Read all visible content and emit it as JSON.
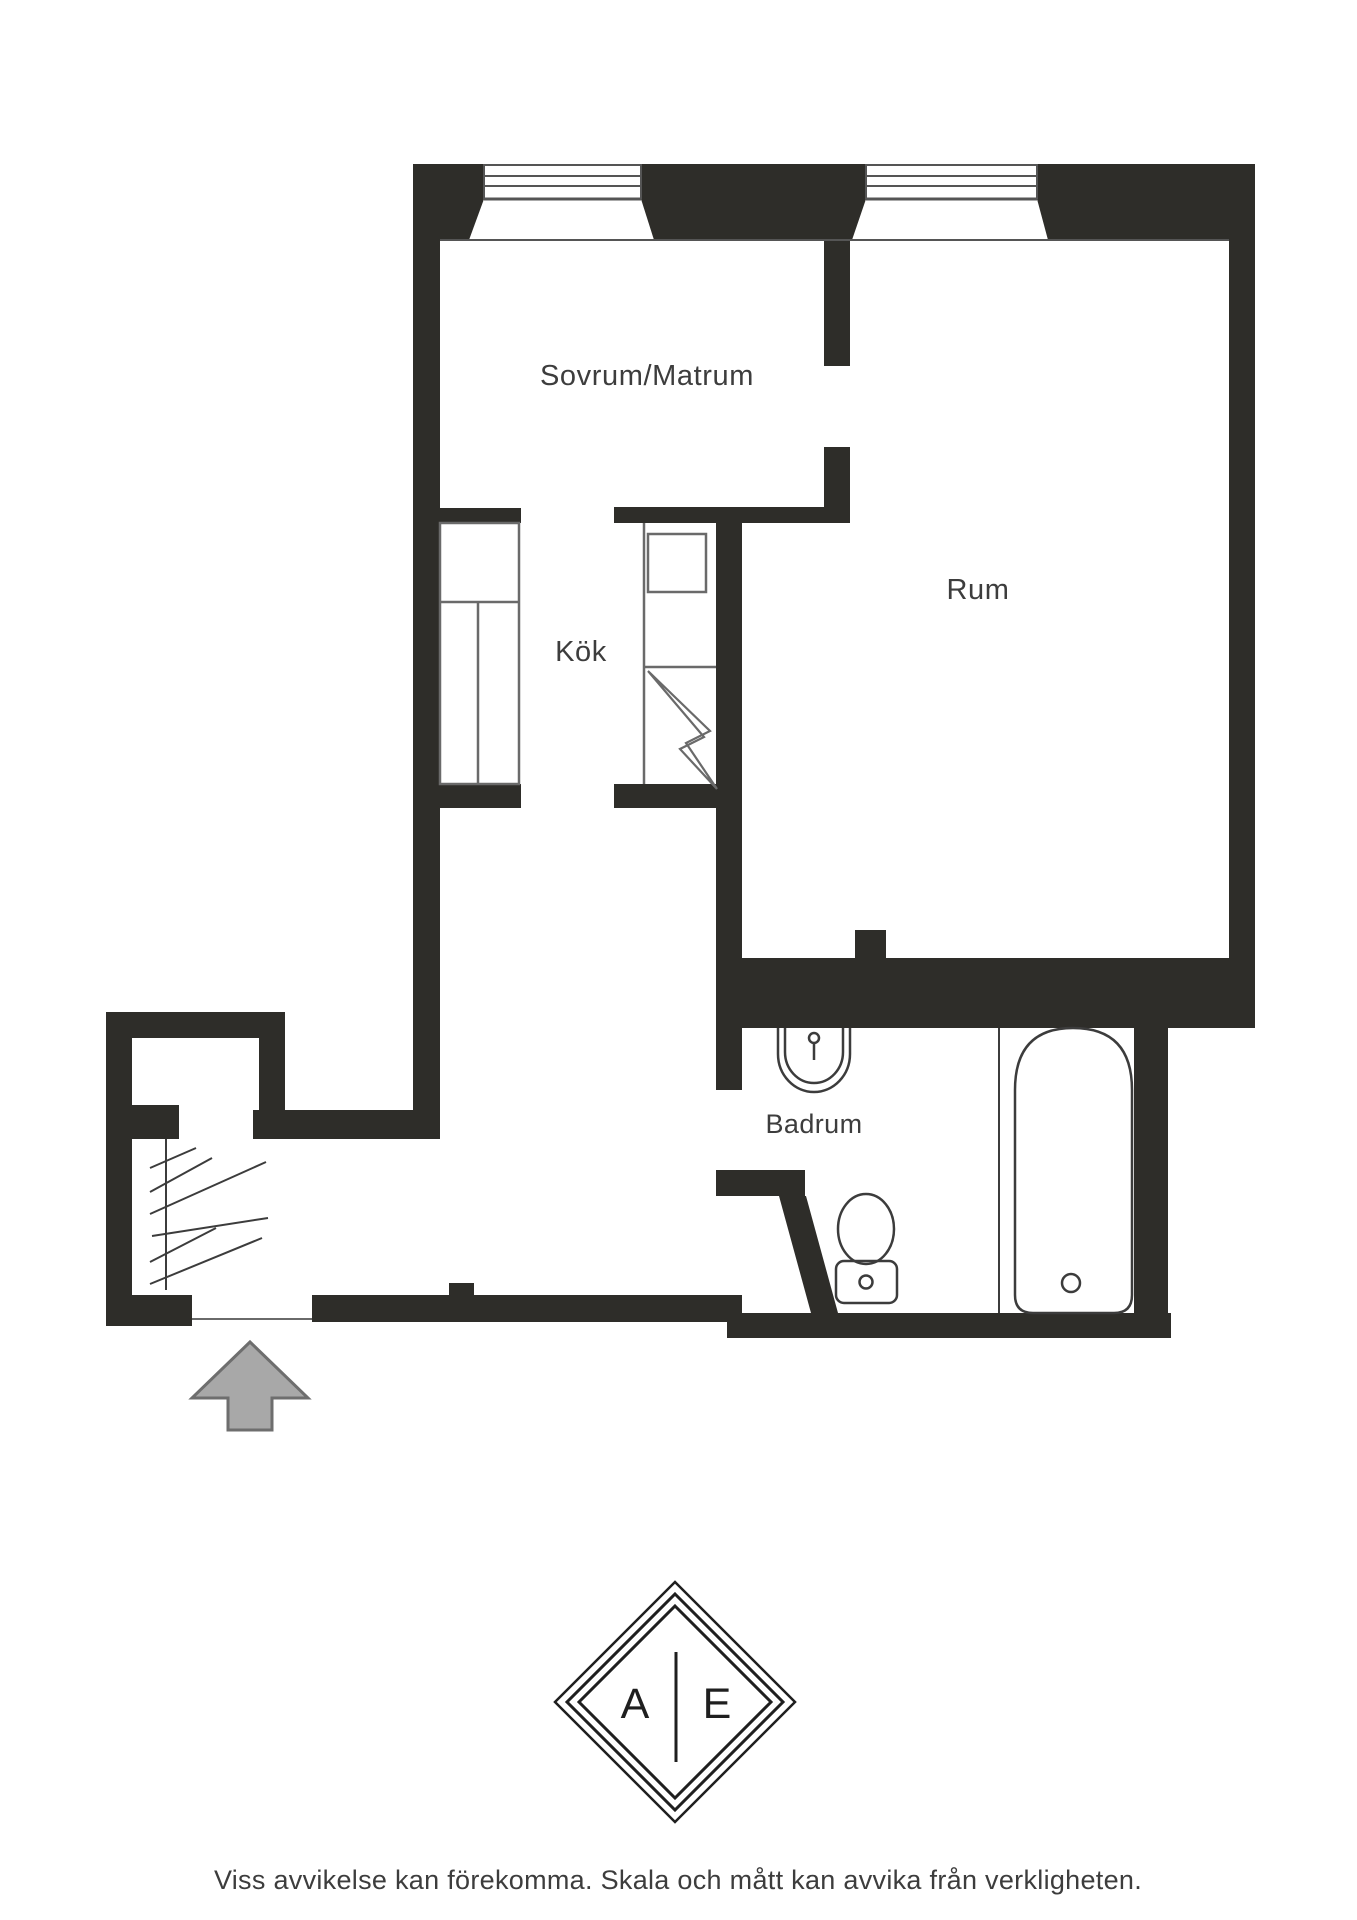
{
  "colors": {
    "wall": "#2e2d29",
    "line": "#555555",
    "cabinet_line": "#6a6a6a",
    "fixture": "#3c3c3c",
    "text": "#3d3d3d",
    "arrow_fill": "#a8a8a8",
    "arrow_stroke": "#6e6e6e",
    "logo": "#1f1f1f",
    "background": "#ffffff"
  },
  "floor_plan": {
    "rooms": [
      {
        "label": "Sovrum/Matrum"
      },
      {
        "label": "Rum"
      },
      {
        "label": "Kök"
      },
      {
        "label": "Badrum"
      }
    ]
  },
  "logo": {
    "left_letter": "A",
    "right_letter": "E"
  },
  "footer": {
    "disclaimer": "Viss avvikelse kan förekomma. Skala och mått kan avvika från verkligheten."
  }
}
